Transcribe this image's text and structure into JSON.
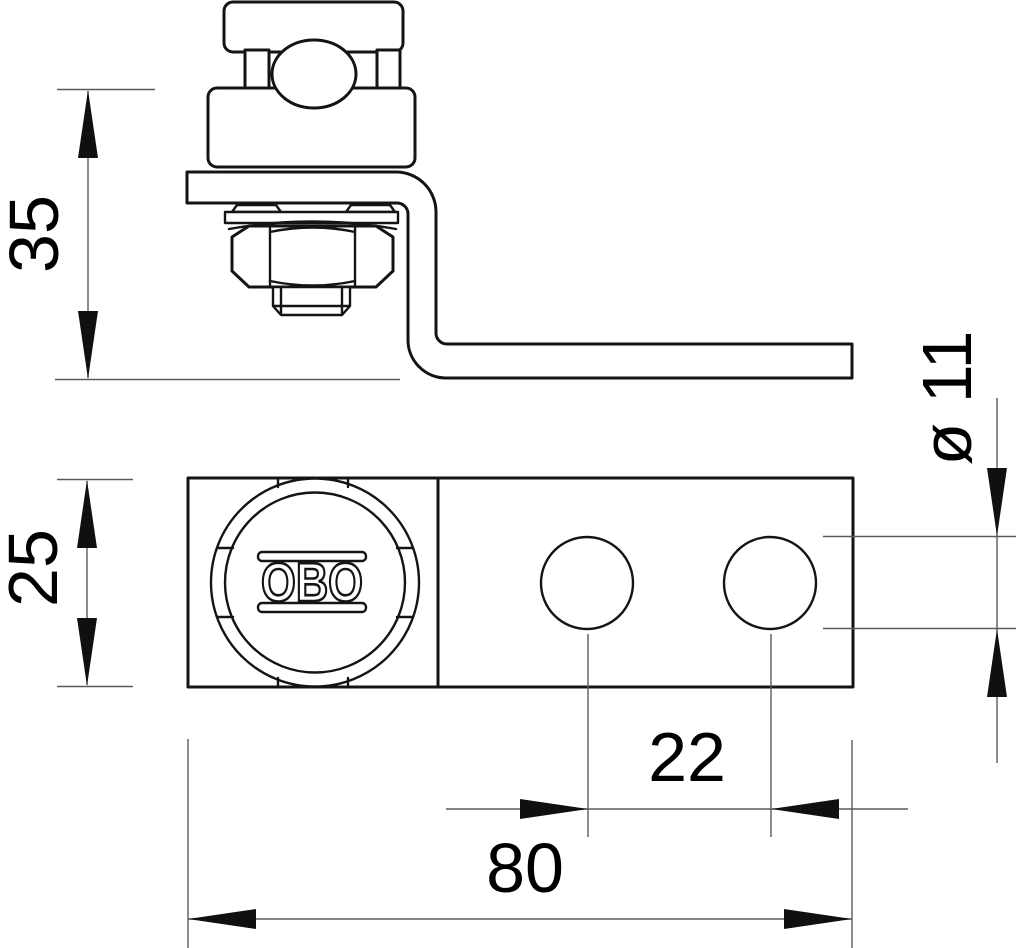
{
  "drawing": {
    "type": "technical-drawing",
    "background": "#ffffff",
    "outline_color": "#141414",
    "dimension_line_color": "#5a5a5a",
    "text_color": "#000000",
    "logo": "OBO",
    "dimensions": {
      "side_height": "35",
      "top_height": "25",
      "hole_diameter": "ø 11",
      "hole_spacing": "22",
      "total_width": "80"
    }
  }
}
